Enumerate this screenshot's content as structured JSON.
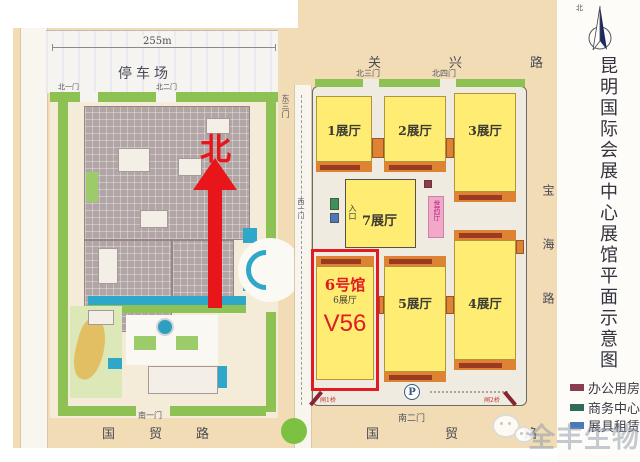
{
  "map": {
    "left_campus": {
      "dimension_label": "255m",
      "parking_label": "停车场",
      "gate_north1": "北一门",
      "gate_north2": "北二门",
      "gate_south1": "南一门",
      "north_marker": "北"
    },
    "middle_road": {
      "gate_east3": "东三门",
      "gate_west1": "西一门"
    },
    "right_campus": {
      "gate_north3": "北三门",
      "gate_north4": "北四门",
      "gate_south2": "南二门",
      "halls": [
        {
          "id": "hall-1",
          "label": "1展厅"
        },
        {
          "id": "hall-2",
          "label": "2展厅"
        },
        {
          "id": "hall-3",
          "label": "3展厅"
        },
        {
          "id": "hall-7",
          "label": "7展厅"
        },
        {
          "id": "hall-5",
          "label": "5展厅"
        },
        {
          "id": "hall-4",
          "label": "4展厅"
        }
      ],
      "hall7_entrance_label": "入口",
      "pink_hall_label": "世药厅",
      "highlight": {
        "building_label": "6号馆",
        "hall_label": "6展厅",
        "booth_label": "V56"
      },
      "parking_symbol": "P",
      "bridge_left": "闸1桥",
      "bridge_right": "闸2桥"
    },
    "roads": {
      "north": "关兴路",
      "south_left": "国贸路",
      "south_right": "国贸路",
      "east": "宝海路"
    }
  },
  "side_panel": {
    "compass_label": "北",
    "title_vertical": "昆明国际会展中心展馆平面示意图",
    "legend": [
      {
        "label": "办公用房",
        "color": "#8a3d50"
      },
      {
        "label": "商务中心",
        "color": "#2e6b58"
      },
      {
        "label": "展具租赁",
        "color": "#4a7ab5"
      }
    ]
  },
  "watermark": "全丰生物",
  "colors": {
    "road_bg": "#f1dcb6",
    "hall_yellow": "#ffec72",
    "highlight_red": "#e01b22",
    "green_strip": "#8dc154",
    "water_teal": "#2fa7c8",
    "pink_hall": "#f2a9c7"
  }
}
